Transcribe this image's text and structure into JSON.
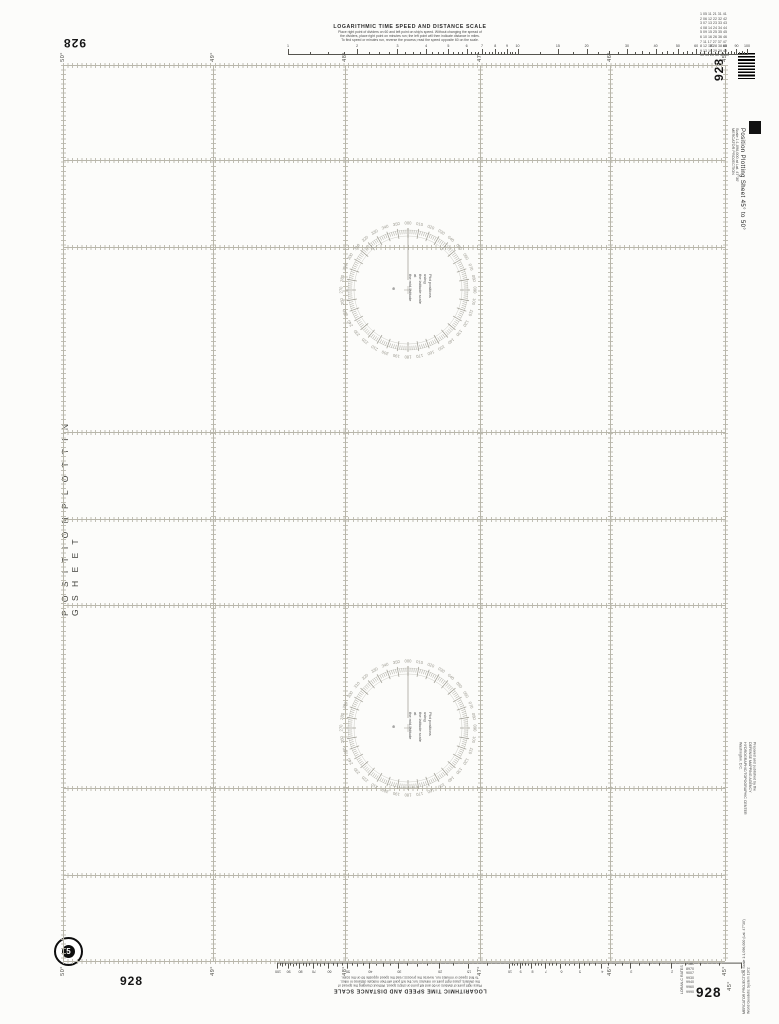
{
  "chart": {
    "number": "928",
    "left_title": "P O S I T I O N   P L O T T I N G   S H E E T",
    "side_title": "Position Plotting Sheet 45° to 50°",
    "side_scale": "Scale 1:1,096,000 at Lat. 47°30'",
    "side_projection": "MERCATOR PROJECTION",
    "corner_degree_top": "50°",
    "corner_degree_bottom": "45°",
    "edition_emblem": "5"
  },
  "grid": {
    "latitude_labels": [
      "50°",
      "49°",
      "48°",
      "47°",
      "46°",
      "45°"
    ]
  },
  "log_scale": {
    "title": "LOGARITHMIC TIME SPEED AND DISTANCE SCALE",
    "instructions": [
      "Place right point of dividers on 60 and left point on ship's speed.  Without changing the spread of",
      "the dividers, place right point on minutes run; the left point will then indicate distance in miles.",
      "To find speed or minutes run, reverse the process; read the speed opposite 60 on the scale."
    ],
    "tick_values": [
      1,
      2,
      3,
      4,
      5,
      6,
      7,
      8,
      9,
      10,
      15,
      20,
      30,
      40,
      50,
      60,
      70,
      80,
      90,
      100
    ]
  },
  "compass_rose": {
    "degree_labels": [
      "000",
      "010",
      "020",
      "030",
      "040",
      "050",
      "060",
      "070",
      "080",
      "090",
      "100",
      "110",
      "120",
      "130",
      "140",
      "150",
      "160",
      "170",
      "180",
      "190",
      "200",
      "210",
      "220",
      "230",
      "240",
      "250",
      "260",
      "270",
      "280",
      "290",
      "300",
      "310",
      "320",
      "330",
      "340",
      "350"
    ],
    "center_note": [
      "Plot positions using",
      "the latitude scale at",
      "the mid-latitude"
    ],
    "center_mark": "⊕"
  },
  "publisher_note": [
    "Prepared and published by the",
    "DEFENSE MAPPING AGENCY",
    "HYDROGRAPHIC/TOPOGRAPHIC CENTER",
    "Washington, D.C."
  ],
  "projection_note": [
    "MERCATOR PROJECTION   Scale 1:1,096,000 (Lat. 47°30')",
    "World Geodetic System 1972"
  ],
  "top_right_codes": [
    "1 05 11 21 31 41",
    "2 06 12 22 32 42",
    "3 07 13 23 33 43",
    "4 08 14 24 34 44",
    "5 09 15 25 35 45",
    "6 10 16 26 36 46",
    "7 11 17 27 37 47",
    "8 12 18 28 38 48",
    "9 13 19 29 39 49",
    "10 14 20 30 40 50"
  ],
  "bottom_right_table": {
    "caption": "LORAN-C RATES",
    "rows": [
      "7980",
      "8970",
      "9007",
      "9930",
      "9940",
      "9960",
      "9990"
    ]
  },
  "colors": {
    "grid_line": "#b8b6aa",
    "rose": "#9a988e",
    "ink": "#1c1c1c",
    "paper": "#fcfcfa"
  }
}
